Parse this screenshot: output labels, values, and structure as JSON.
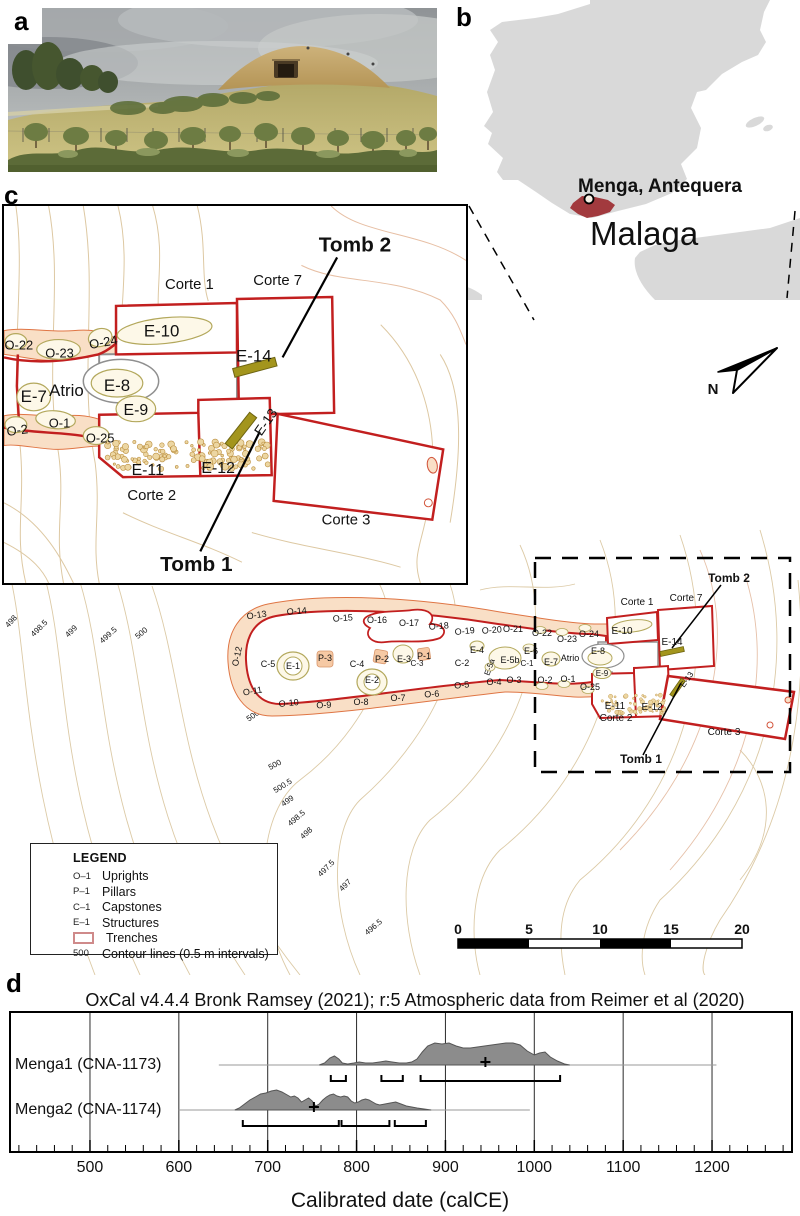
{
  "figure": {
    "panel_labels": {
      "a": "a",
      "b": "b",
      "c": "c",
      "d": "d"
    }
  },
  "map_b": {
    "site_label": "Menga, Antequera",
    "province_label": "Malaga",
    "colors": {
      "land": "#d9d9d9",
      "highlight": "#a23a3e",
      "province_text": "#c0c0c0"
    }
  },
  "inset_c": {
    "labels": [
      {
        "t": "Tomb 2",
        "x": 354,
        "y": 46,
        "s": 21,
        "b": 1
      },
      {
        "t": "Corte 1",
        "x": 187,
        "y": 84,
        "s": 15
      },
      {
        "t": "Corte 7",
        "x": 276,
        "y": 80,
        "s": 15
      },
      {
        "t": "E-10",
        "x": 159,
        "y": 132,
        "s": 17
      },
      {
        "t": "E-14",
        "x": 252,
        "y": 157,
        "s": 17
      },
      {
        "t": "O-22",
        "x": 15,
        "y": 145,
        "s": 13
      },
      {
        "t": "O-23",
        "x": 56,
        "y": 153,
        "s": 13
      },
      {
        "t": "O-24",
        "x": 101,
        "y": 142,
        "s": 13,
        "r": -10
      },
      {
        "t": "E-7",
        "x": 30,
        "y": 198,
        "s": 17
      },
      {
        "t": "Atrio",
        "x": 63,
        "y": 192,
        "s": 17
      },
      {
        "t": "E-8",
        "x": 114,
        "y": 187,
        "s": 17
      },
      {
        "t": "E-9",
        "x": 133,
        "y": 211,
        "s": 16
      },
      {
        "t": "O-2",
        "x": 14,
        "y": 231,
        "s": 13,
        "r": -8
      },
      {
        "t": "O-1",
        "x": 56,
        "y": 224,
        "s": 13
      },
      {
        "t": "O-25",
        "x": 97,
        "y": 239,
        "s": 13
      },
      {
        "t": "E-11",
        "x": 145,
        "y": 272,
        "s": 16
      },
      {
        "t": "E-12",
        "x": 216,
        "y": 270,
        "s": 16
      },
      {
        "t": "E-13",
        "x": 268,
        "y": 221,
        "s": 14,
        "r": -55
      },
      {
        "t": "Corte 2",
        "x": 149,
        "y": 297,
        "s": 15
      },
      {
        "t": "Corte 3",
        "x": 345,
        "y": 322,
        "s": 15
      },
      {
        "t": "Tomb 1",
        "x": 194,
        "y": 369,
        "s": 21,
        "b": 1
      }
    ]
  },
  "site_plan": {
    "north_label": "N",
    "labels": [
      {
        "t": "O-13",
        "x": 257,
        "y": 98,
        "s": 9,
        "r": -8
      },
      {
        "t": "O-14",
        "x": 297,
        "y": 94,
        "s": 9,
        "r": -5
      },
      {
        "t": "O-15",
        "x": 343,
        "y": 101,
        "s": 9,
        "r": -4
      },
      {
        "t": "O-16",
        "x": 377,
        "y": 103,
        "s": 9
      },
      {
        "t": "O-17",
        "x": 409,
        "y": 106,
        "s": 9
      },
      {
        "t": "O-18",
        "x": 439,
        "y": 109,
        "s": 9,
        "r": -4
      },
      {
        "t": "O-19",
        "x": 465,
        "y": 114,
        "s": 9,
        "r": -6
      },
      {
        "t": "O-20",
        "x": 492,
        "y": 113,
        "s": 9,
        "r": -4
      },
      {
        "t": "O-21",
        "x": 513,
        "y": 112,
        "s": 9
      },
      {
        "t": "O-22",
        "x": 542,
        "y": 116,
        "s": 9
      },
      {
        "t": "O-23",
        "x": 567,
        "y": 122,
        "s": 9
      },
      {
        "t": "O-24",
        "x": 589,
        "y": 117,
        "s": 9
      },
      {
        "t": "O-12",
        "x": 240,
        "y": 137,
        "s": 9,
        "r": -78
      },
      {
        "t": "O-11",
        "x": 253,
        "y": 174,
        "s": 9,
        "r": -10
      },
      {
        "t": "O-10",
        "x": 289,
        "y": 186,
        "s": 9,
        "r": -6
      },
      {
        "t": "O-9",
        "x": 324,
        "y": 188,
        "s": 9,
        "r": -3
      },
      {
        "t": "O-8",
        "x": 361,
        "y": 185,
        "s": 9
      },
      {
        "t": "O-7",
        "x": 398,
        "y": 181,
        "s": 9
      },
      {
        "t": "O-6",
        "x": 432,
        "y": 177,
        "s": 9,
        "r": -4
      },
      {
        "t": "O-5",
        "x": 462,
        "y": 168,
        "s": 9,
        "r": -6
      },
      {
        "t": "O-4",
        "x": 494,
        "y": 165,
        "s": 9
      },
      {
        "t": "O-3",
        "x": 514,
        "y": 163,
        "s": 9
      },
      {
        "t": "O-2",
        "x": 545,
        "y": 163,
        "s": 9
      },
      {
        "t": "O-1",
        "x": 568,
        "y": 162,
        "s": 9
      },
      {
        "t": "O-25",
        "x": 590,
        "y": 170,
        "s": 9
      },
      {
        "t": "C-5",
        "x": 268,
        "y": 147,
        "s": 9
      },
      {
        "t": "E-1",
        "x": 293,
        "y": 149,
        "s": 9
      },
      {
        "t": "P-3",
        "x": 325,
        "y": 141,
        "s": 9
      },
      {
        "t": "C-4",
        "x": 357,
        "y": 147,
        "s": 9
      },
      {
        "t": "P-2",
        "x": 382,
        "y": 142,
        "s": 9
      },
      {
        "t": "E-3",
        "x": 404,
        "y": 142,
        "s": 9
      },
      {
        "t": "C-3",
        "x": 417,
        "y": 146,
        "s": 8
      },
      {
        "t": "P-1",
        "x": 424,
        "y": 139,
        "s": 9
      },
      {
        "t": "E-2",
        "x": 372,
        "y": 163,
        "s": 9
      },
      {
        "t": "C-2",
        "x": 462,
        "y": 146,
        "s": 9
      },
      {
        "t": "E-4",
        "x": 477,
        "y": 133,
        "s": 9
      },
      {
        "t": "E-5a",
        "x": 492,
        "y": 148,
        "s": 8,
        "r": -70
      },
      {
        "t": "E-5b",
        "x": 510,
        "y": 143,
        "s": 9
      },
      {
        "t": "E-6",
        "x": 531,
        "y": 134,
        "s": 9
      },
      {
        "t": "C-1",
        "x": 527,
        "y": 146,
        "s": 8
      },
      {
        "t": "E-7",
        "x": 551,
        "y": 145,
        "s": 9
      },
      {
        "t": "Atrio",
        "x": 570,
        "y": 141,
        "s": 9
      },
      {
        "t": "E-8",
        "x": 598,
        "y": 134,
        "s": 9
      },
      {
        "t": "E-9",
        "x": 602,
        "y": 156,
        "s": 8
      },
      {
        "t": "Corte 1",
        "x": 637,
        "y": 85,
        "s": 10
      },
      {
        "t": "Corte 7",
        "x": 686,
        "y": 81,
        "s": 10
      },
      {
        "t": "E-10",
        "x": 622,
        "y": 114,
        "s": 10
      },
      {
        "t": "E-14",
        "x": 672,
        "y": 125,
        "s": 10
      },
      {
        "t": "E-11",
        "x": 615,
        "y": 189,
        "s": 10
      },
      {
        "t": "E-12",
        "x": 652,
        "y": 190,
        "s": 10
      },
      {
        "t": "Corte 2",
        "x": 616,
        "y": 201,
        "s": 10
      },
      {
        "t": "Corte 3",
        "x": 724,
        "y": 215,
        "s": 10
      },
      {
        "t": "E-13",
        "x": 689,
        "y": 161,
        "s": 8,
        "r": -55
      },
      {
        "t": "Tomb 2",
        "x": 729,
        "y": 62,
        "s": 12,
        "b": 1
      },
      {
        "t": "Tomb 1",
        "x": 641,
        "y": 243,
        "s": 12,
        "b": 1
      }
    ],
    "contour_labels": [
      {
        "t": "498",
        "x": 13,
        "y": 103,
        "r": -48
      },
      {
        "t": "498.5",
        "x": 41,
        "y": 110,
        "r": -45
      },
      {
        "t": "499",
        "x": 73,
        "y": 113,
        "r": -45
      },
      {
        "t": "499.5",
        "x": 110,
        "y": 117,
        "r": -42
      },
      {
        "t": "500",
        "x": 143,
        "y": 115,
        "r": -40
      },
      {
        "t": "500.5",
        "x": 257,
        "y": 196,
        "r": -35
      },
      {
        "t": "500",
        "x": 276,
        "y": 247,
        "r": -28
      },
      {
        "t": "500.5",
        "x": 284,
        "y": 268,
        "r": -32
      },
      {
        "t": "499",
        "x": 289,
        "y": 283,
        "r": -35
      },
      {
        "t": "498.5",
        "x": 298,
        "y": 300,
        "r": -40
      },
      {
        "t": "498",
        "x": 308,
        "y": 315,
        "r": -42
      },
      {
        "t": "497.5",
        "x": 328,
        "y": 350,
        "r": -45
      },
      {
        "t": "497",
        "x": 347,
        "y": 367,
        "r": -45
      },
      {
        "t": "496.5",
        "x": 375,
        "y": 409,
        "r": -40
      }
    ],
    "legend": {
      "title": "LEGEND",
      "items": [
        {
          "symbol": "O–1",
          "label": "Uprights"
        },
        {
          "symbol": "P–1",
          "label": "Pillars"
        },
        {
          "symbol": "C–1",
          "label": "Capstones"
        },
        {
          "symbol": "E–1",
          "label": "Structures"
        },
        {
          "symbol": "",
          "label": "Trenches"
        },
        {
          "symbol": "500",
          "label": "Contour lines (0.5 m intervals)"
        }
      ]
    },
    "scale_bar": {
      "ticks": [
        "0",
        "5",
        "10",
        "15",
        "20"
      ]
    }
  },
  "chart_data": {
    "type": "area",
    "subtype": "oxcal-radiocarbon-calibration",
    "title": "OxCal v4.4.4 Bronk Ramsey (2021); r:5 Atmospheric data from Reimer et al (2020)",
    "xlabel": "Calibrated date (calCE)",
    "x_axis": {
      "min": 410,
      "max": 1290,
      "ticks": [
        500,
        600,
        700,
        800,
        900,
        1000,
        1100,
        1200
      ],
      "minor_step": 20
    },
    "series": [
      {
        "name": "Menga1 (CNA-1173)",
        "baseline": [
          645,
          1205
        ],
        "mean": 945,
        "ranges": [
          [
            771,
            788
          ],
          [
            828,
            852
          ],
          [
            872,
            1029
          ]
        ],
        "distribution": [
          [
            758,
            0
          ],
          [
            764,
            2
          ],
          [
            770,
            7
          ],
          [
            775,
            9
          ],
          [
            780,
            6
          ],
          [
            784,
            2
          ],
          [
            790,
            1
          ],
          [
            797,
            2
          ],
          [
            803,
            3
          ],
          [
            810,
            2
          ],
          [
            818,
            2
          ],
          [
            826,
            3
          ],
          [
            833,
            4
          ],
          [
            840,
            3
          ],
          [
            848,
            2
          ],
          [
            856,
            2
          ],
          [
            862,
            3
          ],
          [
            868,
            6
          ],
          [
            874,
            13
          ],
          [
            880,
            19
          ],
          [
            888,
            22
          ],
          [
            896,
            21
          ],
          [
            904,
            22
          ],
          [
            912,
            19
          ],
          [
            920,
            17
          ],
          [
            928,
            17
          ],
          [
            936,
            18
          ],
          [
            944,
            19
          ],
          [
            952,
            20
          ],
          [
            960,
            21
          ],
          [
            968,
            22
          ],
          [
            976,
            22
          ],
          [
            984,
            20
          ],
          [
            992,
            14
          ],
          [
            1000,
            10
          ],
          [
            1006,
            12
          ],
          [
            1012,
            13
          ],
          [
            1018,
            8
          ],
          [
            1026,
            4
          ],
          [
            1034,
            1
          ],
          [
            1040,
            0
          ]
        ]
      },
      {
        "name": "Menga2 (CNA-1174)",
        "baseline": [
          600,
          995
        ],
        "mean": 752,
        "ranges": [
          [
            672,
            780
          ],
          [
            783,
            837
          ],
          [
            843,
            878
          ]
        ],
        "distribution": [
          [
            663,
            0
          ],
          [
            668,
            2
          ],
          [
            674,
            6
          ],
          [
            680,
            10
          ],
          [
            686,
            13
          ],
          [
            692,
            16
          ],
          [
            698,
            17
          ],
          [
            704,
            19
          ],
          [
            710,
            20
          ],
          [
            716,
            18
          ],
          [
            722,
            15
          ],
          [
            726,
            13
          ],
          [
            730,
            14
          ],
          [
            734,
            12
          ],
          [
            738,
            8
          ],
          [
            742,
            10
          ],
          [
            746,
            12
          ],
          [
            750,
            9
          ],
          [
            754,
            4
          ],
          [
            758,
            6
          ],
          [
            762,
            10
          ],
          [
            766,
            13
          ],
          [
            770,
            15
          ],
          [
            774,
            16
          ],
          [
            778,
            14
          ],
          [
            782,
            13
          ],
          [
            786,
            14
          ],
          [
            790,
            13
          ],
          [
            794,
            9
          ],
          [
            798,
            7
          ],
          [
            802,
            8
          ],
          [
            806,
            10
          ],
          [
            810,
            11
          ],
          [
            814,
            10
          ],
          [
            818,
            8
          ],
          [
            822,
            6
          ],
          [
            826,
            5
          ],
          [
            832,
            6
          ],
          [
            838,
            7
          ],
          [
            844,
            8
          ],
          [
            850,
            6
          ],
          [
            856,
            4
          ],
          [
            862,
            3
          ],
          [
            868,
            2
          ],
          [
            876,
            1
          ],
          [
            884,
            0
          ]
        ]
      }
    ]
  }
}
